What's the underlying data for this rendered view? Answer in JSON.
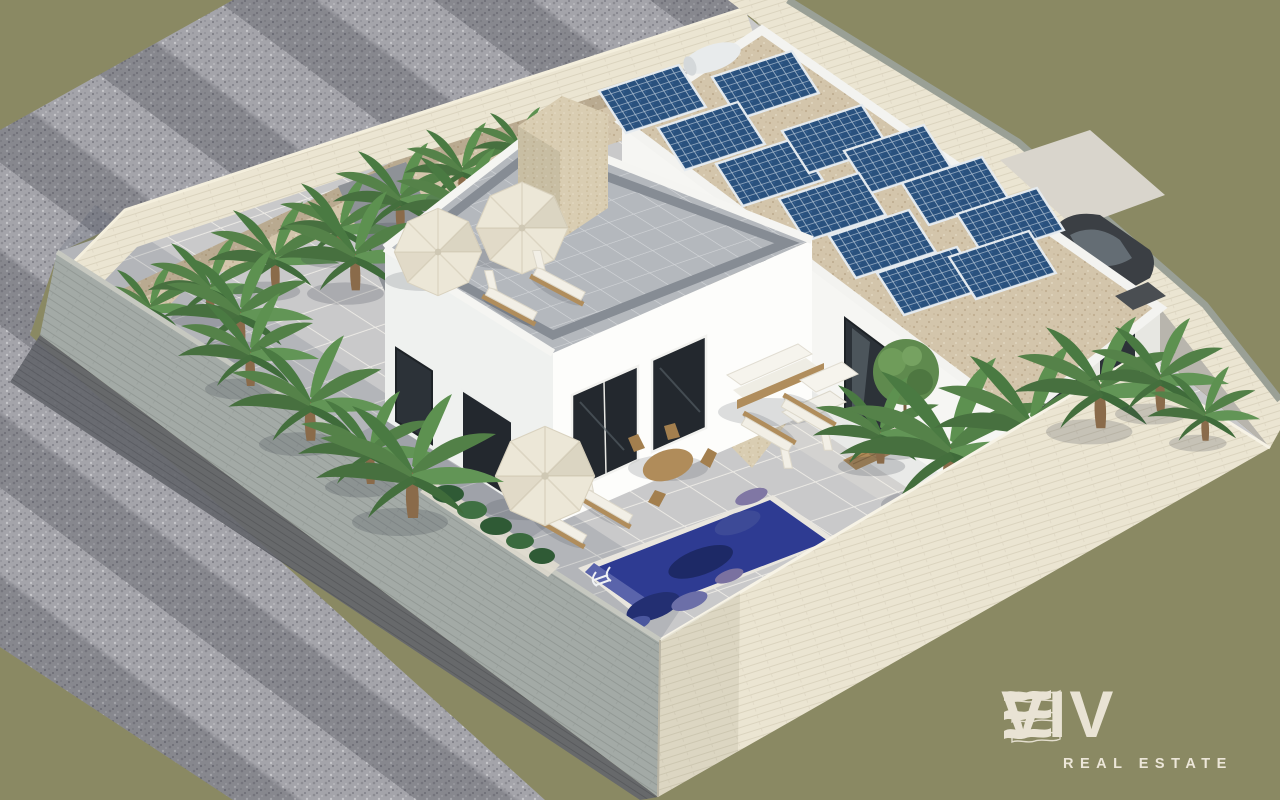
{
  "window": {
    "width": 1280,
    "height": 800
  },
  "branding": {
    "wordmark": "VIV",
    "wordmark_full": "VIVE",
    "tagline": "REAL ESTATE",
    "logo_color": "#e9e3d4"
  },
  "scene": {
    "type": "real-estate-3d-aerial-render",
    "subject": "Two modern white villas with rooftop solar panels, roof terrace, palm garden and private pool inside a walled corner plot",
    "background_color": "#8a8963",
    "counts": {
      "villas": 2,
      "solar_panels": 12,
      "solar_water_heaters": 1,
      "parasols": 3,
      "sun_loungers": 6,
      "swimming_pools": 1,
      "cars": 1
    },
    "colors": {
      "olive_background": "#8a8963",
      "perimeter_wall_cream": "#ebe5d2",
      "perimeter_wall_gray": "#a3aaa6",
      "terrain_gravel": "#a4a4aa",
      "courtyard_paving": "#c9c9ca",
      "villa_white": "#f6f6f3",
      "window_glass": "#2c3238",
      "solar_panel_blue": "#29517e",
      "pool_water": "#2e3b92",
      "palm_green": "#4f7f48",
      "planting_bed_tan": "#d3c5ab",
      "roof_tile_gray": "#b4b8bd",
      "stone_feature_tan": "#d9cdb2"
    }
  }
}
